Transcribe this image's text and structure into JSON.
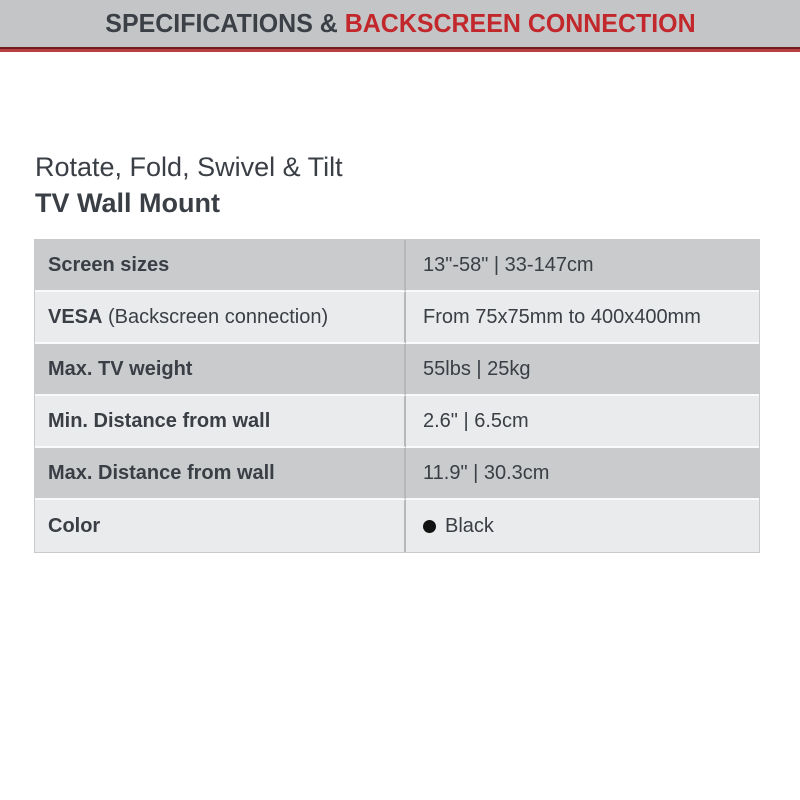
{
  "header": {
    "title_dark": "SPECIFICATIONS & ",
    "title_red": "BACKSCREEN CONNECTION",
    "bg_color": "#c4c5c7",
    "dark_text_color": "#3b3f46",
    "red_text_color": "#c2272c",
    "underline_dark_color": "#6f1d1f",
    "underline_red_color": "#b84042"
  },
  "intro": {
    "subtitle": "Rotate, Fold, Swivel & Tilt",
    "title": "TV Wall Mount"
  },
  "spec_table": {
    "row_dark_bg": "#c9cbcd",
    "row_light_bg": "#eaebec",
    "divider_color": "#b6b8ba",
    "text_color": "#3a3e45",
    "rows": [
      {
        "label": "Screen sizes",
        "label_suffix": "",
        "value": "13\"-58\" | 33-147cm",
        "has_bullet": false
      },
      {
        "label": "VESA",
        "label_suffix": " (Backscreen connection)",
        "value": "From 75x75mm to 400x400mm",
        "has_bullet": false
      },
      {
        "label": "Max. TV weight",
        "label_suffix": "",
        "value": "55lbs | 25kg",
        "has_bullet": false
      },
      {
        "label": "Min. Distance from wall",
        "label_suffix": "",
        "value": "2.6\" | 6.5cm",
        "has_bullet": false
      },
      {
        "label": "Max. Distance from wall",
        "label_suffix": "",
        "value": "11.9\" | 30.3cm",
        "has_bullet": false
      },
      {
        "label": "Color",
        "label_suffix": "",
        "value": "Black",
        "has_bullet": true
      }
    ]
  }
}
